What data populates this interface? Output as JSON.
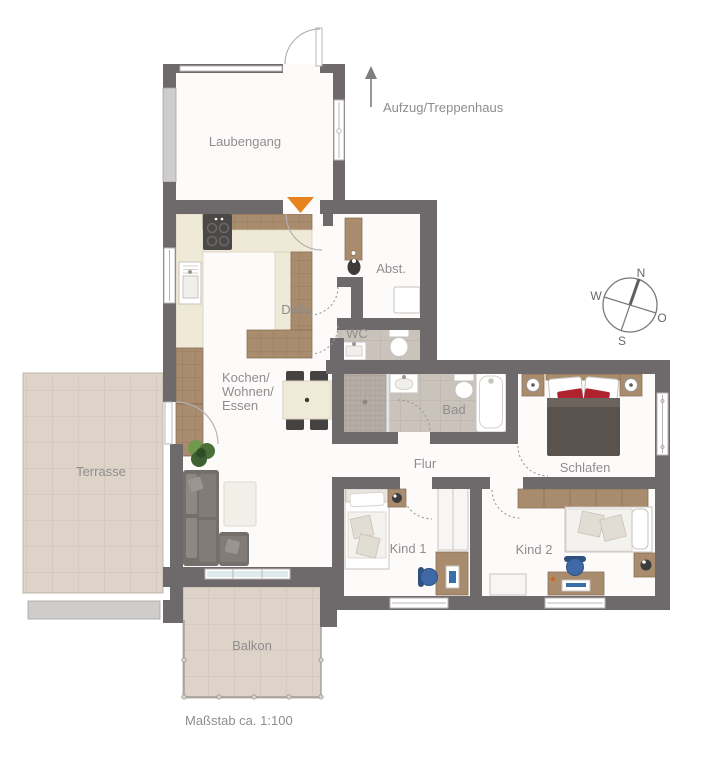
{
  "rooms": {
    "laubengang": "Laubengang",
    "diele": "Diele",
    "abst": "Abst.",
    "wc": "WC",
    "bad": "Bad",
    "flur": "Flur",
    "schlafen": "Schlafen",
    "kind1": "Kind 1",
    "kind2": "Kind 2",
    "terrasse": "Terrasse",
    "balkon": "Balkon",
    "kochen": [
      "Kochen/",
      "Wohnen/",
      "Essen"
    ]
  },
  "annotations": {
    "aufzug": "Aufzug/Treppenhaus",
    "massstab": "Maßstab ca. 1:100"
  },
  "compass": {
    "n": "N",
    "o": "O",
    "s": "S",
    "w": "W"
  },
  "colors": {
    "wall": "#6e6a6b",
    "floor": "#fcfbfa",
    "outdoor_tile": "#ddd3c8",
    "bath_tile": "#cac3bc",
    "wood": "#a98b6d",
    "counter": "#efe9d7",
    "accent_orange": "#e8821e",
    "accent_red": "#b1222f",
    "sofa_grey": "#746f6b",
    "duvet": "#5a534d",
    "chair_blue": "#3f69a6",
    "label": "#8f8d8d",
    "rail": "#cfcccc"
  }
}
